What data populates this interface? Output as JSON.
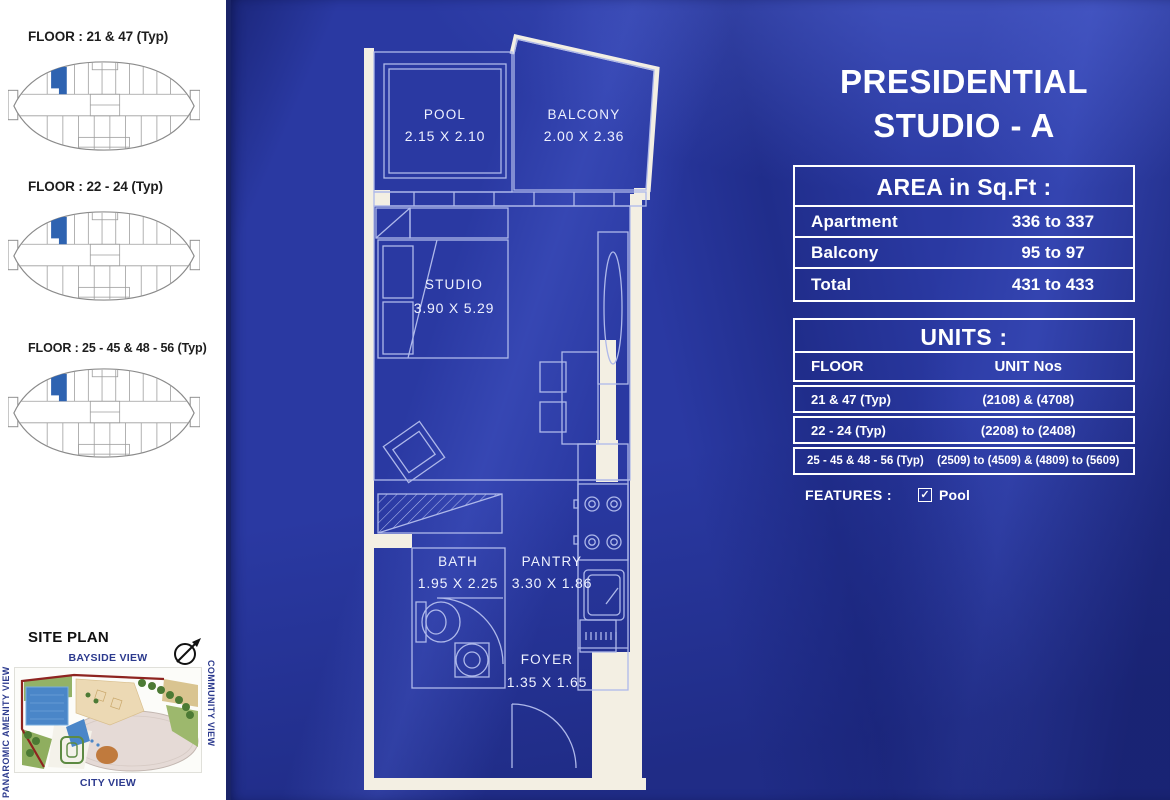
{
  "title": {
    "line1": "PRESIDENTIAL",
    "line2": "STUDIO - A"
  },
  "key_plans": [
    {
      "label": "FLOOR : 21 & 47 (Typ)"
    },
    {
      "label": "FLOOR : 22 - 24 (Typ)"
    },
    {
      "label": "FLOOR : 25 - 45 & 48 - 56 (Typ)"
    }
  ],
  "site_plan": {
    "title": "SITE PLAN",
    "view_top": "BAYSIDE VIEW",
    "view_bottom": "CITY VIEW",
    "view_left": "PANAROMIC AMENITY VIEW",
    "view_right": "COMMUNITY VIEW"
  },
  "floor_plan": {
    "rooms": [
      {
        "name": "POOL",
        "dims": "2.15 X 2.10"
      },
      {
        "name": "BALCONY",
        "dims": "2.00 X 2.36"
      },
      {
        "name": "STUDIO",
        "dims": "3.90 X 5.29"
      },
      {
        "name": "BATH",
        "dims": "1.95 X 2.25"
      },
      {
        "name": "PANTRY",
        "dims": "3.30 X 1.86"
      },
      {
        "name": "FOYER",
        "dims": "1.35 X 1.65"
      }
    ]
  },
  "area_table": {
    "header": "AREA in Sq.Ft :",
    "rows": [
      {
        "label": "Apartment",
        "value": "336 to 337"
      },
      {
        "label": "Balcony",
        "value": "95 to 97"
      },
      {
        "label": "Total",
        "value": "431 to 433"
      }
    ]
  },
  "units_table": {
    "header": "UNITS :",
    "col_floor": "FLOOR",
    "col_units": "UNIT Nos",
    "rows": [
      {
        "floor": "21 & 47 (Typ)",
        "units": "(2108) & (4708)"
      },
      {
        "floor": "22 - 24 (Typ)",
        "units": "(2208) to (2408)"
      },
      {
        "floor": "25 - 45 & 48 - 56 (Typ)",
        "units": "(2509) to (4509) & (4809) to (5609)"
      }
    ]
  },
  "features": {
    "label": "FEATURES :",
    "item": "Pool"
  },
  "colors": {
    "fabric_blue": "#2a39a2",
    "fabric_dark_fold": "#1b2570",
    "fabric_light_fold": "#4354bb",
    "wall_white": "#f3efe3",
    "plan_line": "#aeb8ea",
    "highlight_unit_blue": "#2e63b1",
    "view_label_blue": "#2c3a8e",
    "text_white": "#ffffff"
  }
}
